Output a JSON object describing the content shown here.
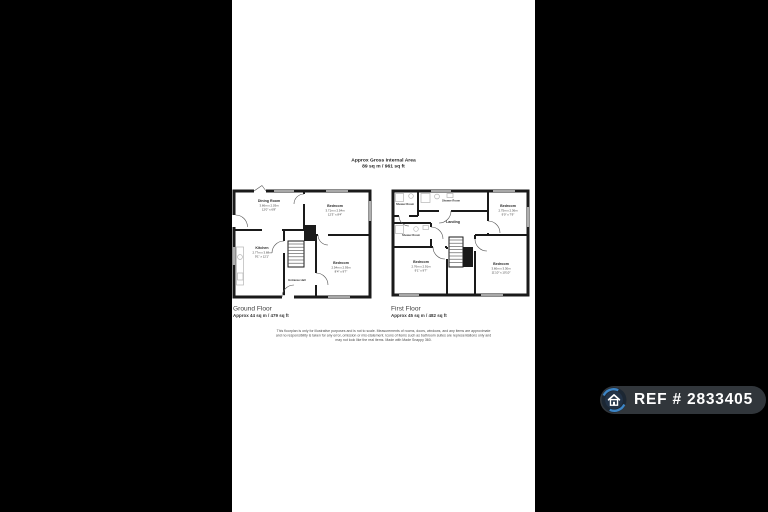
{
  "header": {
    "title": "Approx Gross Internal Area",
    "area": "89 sq m / 961 sq ft"
  },
  "floors": {
    "ground": {
      "label": "Ground Floor",
      "area": "Approx 44 sq m / 479 sq ft",
      "rooms": {
        "dining": {
          "name": "Dining Room",
          "metric": "3.66m x 2.03m",
          "imperial": "12'0\" x 6'8\""
        },
        "bedroom_front": {
          "name": "Bedroom",
          "metric": "3.71m x 2.54m",
          "imperial": "12'3\" x 8'4\""
        },
        "kitchen": {
          "name": "Kitchen",
          "metric": "2.77m x 3.68m",
          "imperial": "9'1\" x 12'1\""
        },
        "bedroom_rear": {
          "name": "Bedroom",
          "metric": "2.54m x 2.93m",
          "imperial": "8'4\" x 9'7\""
        },
        "hall": {
          "name": "Entrance Hall"
        }
      }
    },
    "first": {
      "label": "First Floor",
      "area": "Approx 45 sq m / 482 sq ft",
      "rooms": {
        "shower_a": {
          "name": "Shower Room"
        },
        "shower_b": {
          "name": "Shower Room"
        },
        "shower_c": {
          "name": "Shower Room"
        },
        "landing": {
          "name": "Landing"
        },
        "bedroom_front": {
          "name": "Bedroom",
          "metric": "2.75m x 2.36m",
          "imperial": "9'0\" x 7'9\""
        },
        "bedroom_left": {
          "name": "Bedroom",
          "metric": "2.76m x 2.91m",
          "imperial": "9'1\" x 9'7\""
        },
        "bedroom_rear": {
          "name": "Bedroom",
          "metric": "3.60m x 3.30m",
          "imperial": "11'10\" x 10'10\""
        }
      }
    }
  },
  "disclaimer": {
    "line1": "This floorplan is only for illustrative purposes and is not to scale. Measurements of rooms, doors, windows, and any items are approximate",
    "line2": "and no responsibility is taken for any error, omission or mis-statement. Icons of items such as bathroom suites are representations only and",
    "line3": "may not look like the real items. Made with Made Snappy 360."
  },
  "badge": {
    "ref": "REF # 2833405"
  },
  "colors": {
    "wall": "#1a1a1a",
    "paper": "#ffffff",
    "letterbox": "#000000",
    "badge_bg": "#34393e",
    "badge_accent": "#3d85c6",
    "fixture": "#b5b5b5"
  }
}
